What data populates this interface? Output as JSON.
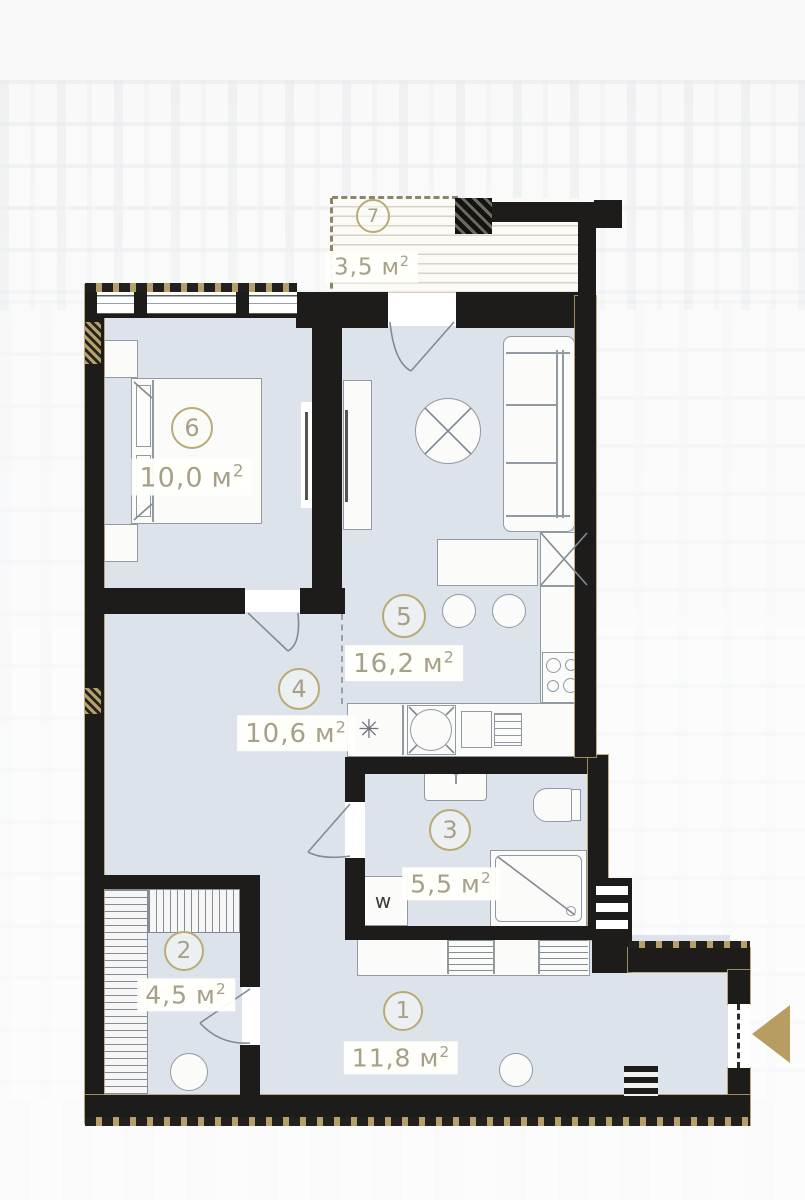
{
  "plan": {
    "unit_suffix": "м",
    "unit_sup": "2",
    "rooms": [
      {
        "number": "1",
        "area": "11,8",
        "name": "hallway"
      },
      {
        "number": "2",
        "area": "4,5",
        "name": "wardrobe"
      },
      {
        "number": "3",
        "area": "5,5",
        "name": "bathroom"
      },
      {
        "number": "4",
        "area": "10,6",
        "name": "dining-area"
      },
      {
        "number": "5",
        "area": "16,2",
        "name": "kitchen-living"
      },
      {
        "number": "6",
        "area": "10,0",
        "name": "bedroom"
      },
      {
        "number": "7",
        "area": "3,5",
        "name": "balcony"
      }
    ],
    "labels": {
      "washing_machine": "w",
      "fridge_symbol": "✳"
    },
    "colors": {
      "wall": "#1d1c1a",
      "floor": "#dce3ea",
      "accent_gold": "#b49d66",
      "label_text": "#a7a088",
      "furniture_line": "#9199a1",
      "entrance_arrow": "#b89d62"
    }
  }
}
